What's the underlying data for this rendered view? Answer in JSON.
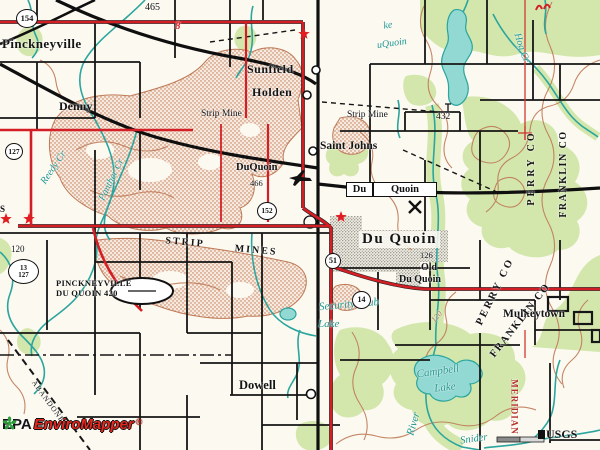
{
  "meta": {
    "title": "EPA EnviroMapper topographic map, Du Quoin Illinois area"
  },
  "labels": {
    "pinckneyville": "Pinckneyville",
    "denny": "Denny",
    "sunfield": "Sunfield",
    "holden": "Holden",
    "saint_johns": "Saint Johns",
    "duquoin_small": "DuQuoin",
    "elev_466": "466",
    "quad_du": "Du",
    "quad_quoin": "Quoin",
    "duquoin_city": "Du Quoin",
    "strip_mine_left": "Strip Mine",
    "strip_mine_right": "Strip Mine",
    "strip_word": "STRIP",
    "mines_word": "MINES",
    "airport_line1": "PINCKNEYVILLE",
    "airport_line2": "DU QUOIN 420",
    "elev_120": "120",
    "edge_s": "S",
    "old_word": "Old",
    "old_duquoin": "Du Quoin",
    "elev_126": "126",
    "dowell": "Dowell",
    "mulkeytown": "Mulkeytown",
    "elev_432": "432",
    "elev_465": "465",
    "red_8": "8",
    "abandoned": "ABANDONED",
    "usgs": "USGS",
    "perry_co_upper": "PERRY CO",
    "franklin_co_upper": "FRANKLIN CO",
    "perry_co_lower": "PERRY CO",
    "franklin_co_lower": "FRANKLIN CO",
    "meridian": "MERIDIAN",
    "lake_frag1": "ke",
    "lake_frag2": "uQuoin",
    "hog_cr": "Hog Cr",
    "panther_cr": "Panther Cr",
    "reedy_cr": "Reedy Cr",
    "security_club": "Security Club",
    "security_lake": "Lake",
    "campbell": "Campbell",
    "campbell_lake": "Lake",
    "river": "River",
    "snider": "Snider",
    "contour_120": "120"
  },
  "shields": {
    "s154": "154",
    "s127_upper": "127",
    "s13": "13",
    "s127_lower": "127",
    "s152": "152",
    "s51": "51",
    "s14": "14"
  },
  "credits": {
    "epa": "EPA",
    "product": "EnviroMapper",
    "registered": "®"
  },
  "colors": {
    "highway_red": "#d31e25",
    "water_teal": "#2ba59d",
    "contour_brown": "#bf7a57",
    "vegetation_green": "#d3e7ad",
    "strip_mine_stipple": "#c0734f",
    "paper": "#fcf9f0",
    "logo_red": "#e6261f"
  }
}
